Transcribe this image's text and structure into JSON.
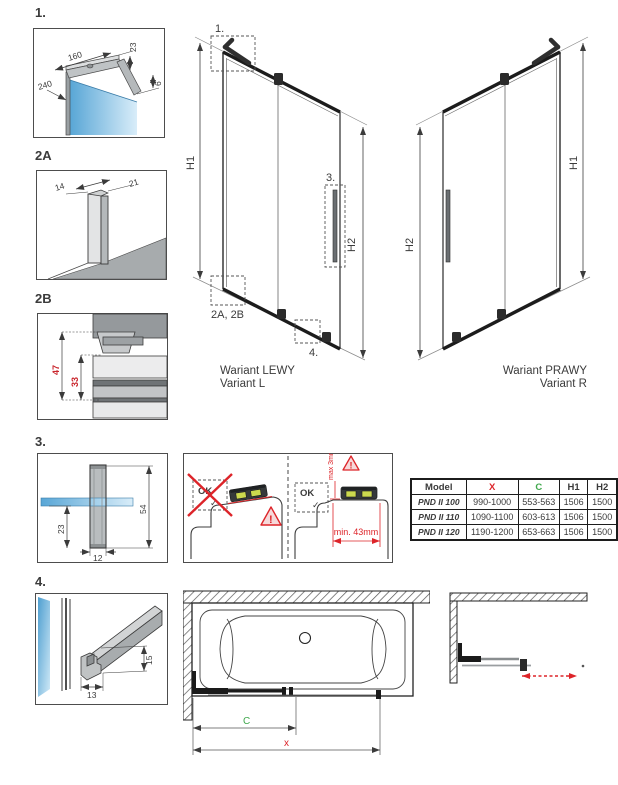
{
  "panel1": {
    "label": "1.",
    "dim_length": "160",
    "dim_height": "23",
    "dim_depth": "240",
    "dim_gap": "6"
  },
  "panel2a": {
    "label": "2A",
    "dim_left": "14",
    "dim_right": "21"
  },
  "panel2b": {
    "label": "2B",
    "dim_outer": "47",
    "dim_inner": "33"
  },
  "panel3": {
    "label": "3.",
    "dim_total": "54",
    "dim_below": "23",
    "dim_width": "12"
  },
  "panel4": {
    "label": "4.",
    "dim_width": "13",
    "dim_height": "15"
  },
  "elevation_left": {
    "callout_1": "1.",
    "callout_3": "3.",
    "callout_2ab": "2A, 2B",
    "callout_4": "4.",
    "h1": "H1",
    "h2": "H2",
    "caption_pl": "Wariant LEWY",
    "caption_en": "Variant L"
  },
  "elevation_right": {
    "h1": "H1",
    "h2": "H2",
    "caption_pl": "Wariant PRAWY",
    "caption_en": "Variant R"
  },
  "install": {
    "ok_bad": "OK",
    "check_bad": "✓",
    "ok_good": "OK",
    "check_good": "✓",
    "warn_bad": "!",
    "warn_good": "!",
    "max_gap": "max 3mm",
    "min_width": "min. 43mm"
  },
  "spec_table": {
    "headers": [
      "Model",
      "X",
      "C",
      "H1",
      "H2"
    ],
    "rows": [
      [
        "PND II 100",
        "990-1000",
        "553-563",
        "1506",
        "1500"
      ],
      [
        "PND II 110",
        "1090-1100",
        "603-613",
        "1506",
        "1500"
      ],
      [
        "PND II 120",
        "1190-1200",
        "653-663",
        "1506",
        "1500"
      ]
    ]
  },
  "tub_view": {
    "dim_c": "C",
    "dim_x": "x"
  },
  "colors": {
    "red": "#dd2429",
    "green": "#3fa84c",
    "dim_red": "#c9252c",
    "glass_dark": "#58a6d6",
    "glass_light": "#d9edf9"
  }
}
